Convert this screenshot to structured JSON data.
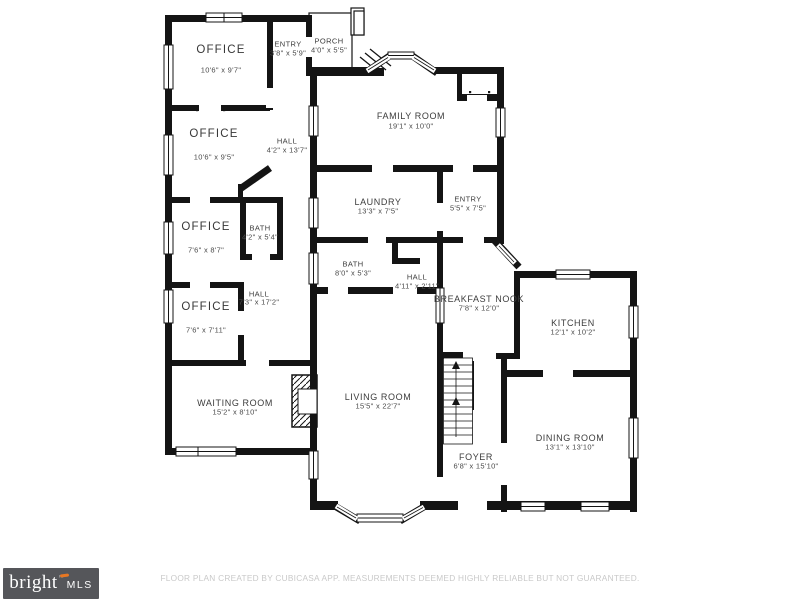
{
  "plan": {
    "rooms": [
      {
        "name": "OFFICE",
        "dims": "10'6\" x 9'7\"",
        "cx": 221,
        "name_y": 50,
        "dims_y": 70,
        "size": "lg"
      },
      {
        "name": "ENTRY",
        "dims": "3'8\" x 5'9\"",
        "cx": 288,
        "name_y": 44,
        "dims_y": 53,
        "size": "sm"
      },
      {
        "name": "PORCH",
        "dims": "4'0\" x 5'5\"",
        "cx": 329,
        "name_y": 41,
        "dims_y": 50,
        "size": "sm"
      },
      {
        "name": "OFFICE",
        "dims": "10'6\" x 9'5\"",
        "cx": 214,
        "name_y": 134,
        "dims_y": 157,
        "size": "lg"
      },
      {
        "name": "HALL",
        "dims": "4'2\" x 13'7\"",
        "cx": 287,
        "name_y": 141,
        "dims_y": 150,
        "size": "sm"
      },
      {
        "name": "FAMILY ROOM",
        "dims": "19'1\" x 10'0\"",
        "cx": 411,
        "name_y": 116,
        "dims_y": 126,
        "size": "md"
      },
      {
        "name": "LAUNDRY",
        "dims": "13'3\" x 7'5\"",
        "cx": 378,
        "name_y": 202,
        "dims_y": 211,
        "size": "md"
      },
      {
        "name": "ENTRY",
        "dims": "5'5\" x 7'5\"",
        "cx": 468,
        "name_y": 199,
        "dims_y": 208,
        "size": "sm"
      },
      {
        "name": "OFFICE",
        "dims": "7'6\" x 8'7\"",
        "cx": 206,
        "name_y": 227,
        "dims_y": 250,
        "size": "lg"
      },
      {
        "name": "BATH",
        "dims": "4'2\" x 5'4\"",
        "cx": 260,
        "name_y": 228,
        "dims_y": 237,
        "size": "sm"
      },
      {
        "name": "OFFICE",
        "dims": "7'6\" x 7'11\"",
        "cx": 206,
        "name_y": 307,
        "dims_y": 330,
        "size": "lg"
      },
      {
        "name": "HALL",
        "dims": "7'3\" x 17'2\"",
        "cx": 259,
        "name_y": 294,
        "dims_y": 302,
        "size": "sm"
      },
      {
        "name": "BATH",
        "dims": "8'0\" x 5'3\"",
        "cx": 353,
        "name_y": 264,
        "dims_y": 273,
        "size": "sm"
      },
      {
        "name": "HALL",
        "dims": "4'11\" x 2'11\"",
        "cx": 417,
        "name_y": 277,
        "dims_y": 286,
        "size": "sm"
      },
      {
        "name": "BREAKFAST NOOK",
        "dims": "7'8\" x 12'0\"",
        "cx": 479,
        "name_y": 299,
        "dims_y": 308,
        "size": "md"
      },
      {
        "name": "KITCHEN",
        "dims": "12'1\" x 10'2\"",
        "cx": 573,
        "name_y": 323,
        "dims_y": 332,
        "size": "md"
      },
      {
        "name": "WAITING ROOM",
        "dims": "15'2\" x 8'10\"",
        "cx": 235,
        "name_y": 403,
        "dims_y": 412,
        "size": "md"
      },
      {
        "name": "LIVING ROOM",
        "dims": "15'5\" x 22'7\"",
        "cx": 378,
        "name_y": 397,
        "dims_y": 406,
        "size": "md"
      },
      {
        "name": "FOYER",
        "dims": "6'8\" x 15'10\"",
        "cx": 476,
        "name_y": 457,
        "dims_y": 466,
        "size": "md"
      },
      {
        "name": "DINING ROOM",
        "dims": "13'1\" x 13'10\"",
        "cx": 570,
        "name_y": 438,
        "dims_y": 447,
        "size": "md"
      }
    ]
  },
  "footer": {
    "logo": {
      "brand": "bright",
      "tm": "™",
      "suffix": "MLS",
      "bg_color": "#55565a",
      "accent_color": "#e87722",
      "text_color": "#ffffff"
    },
    "disclaimer": "FLOOR PLAN CREATED BY CUBICASA APP. MEASUREMENTS DEEMED HIGHLY RELIABLE BUT NOT GUARANTEED.",
    "disclaimer_color": "#c9c9c9"
  },
  "colors": {
    "wall": "#141414",
    "background": "#ffffff"
  }
}
